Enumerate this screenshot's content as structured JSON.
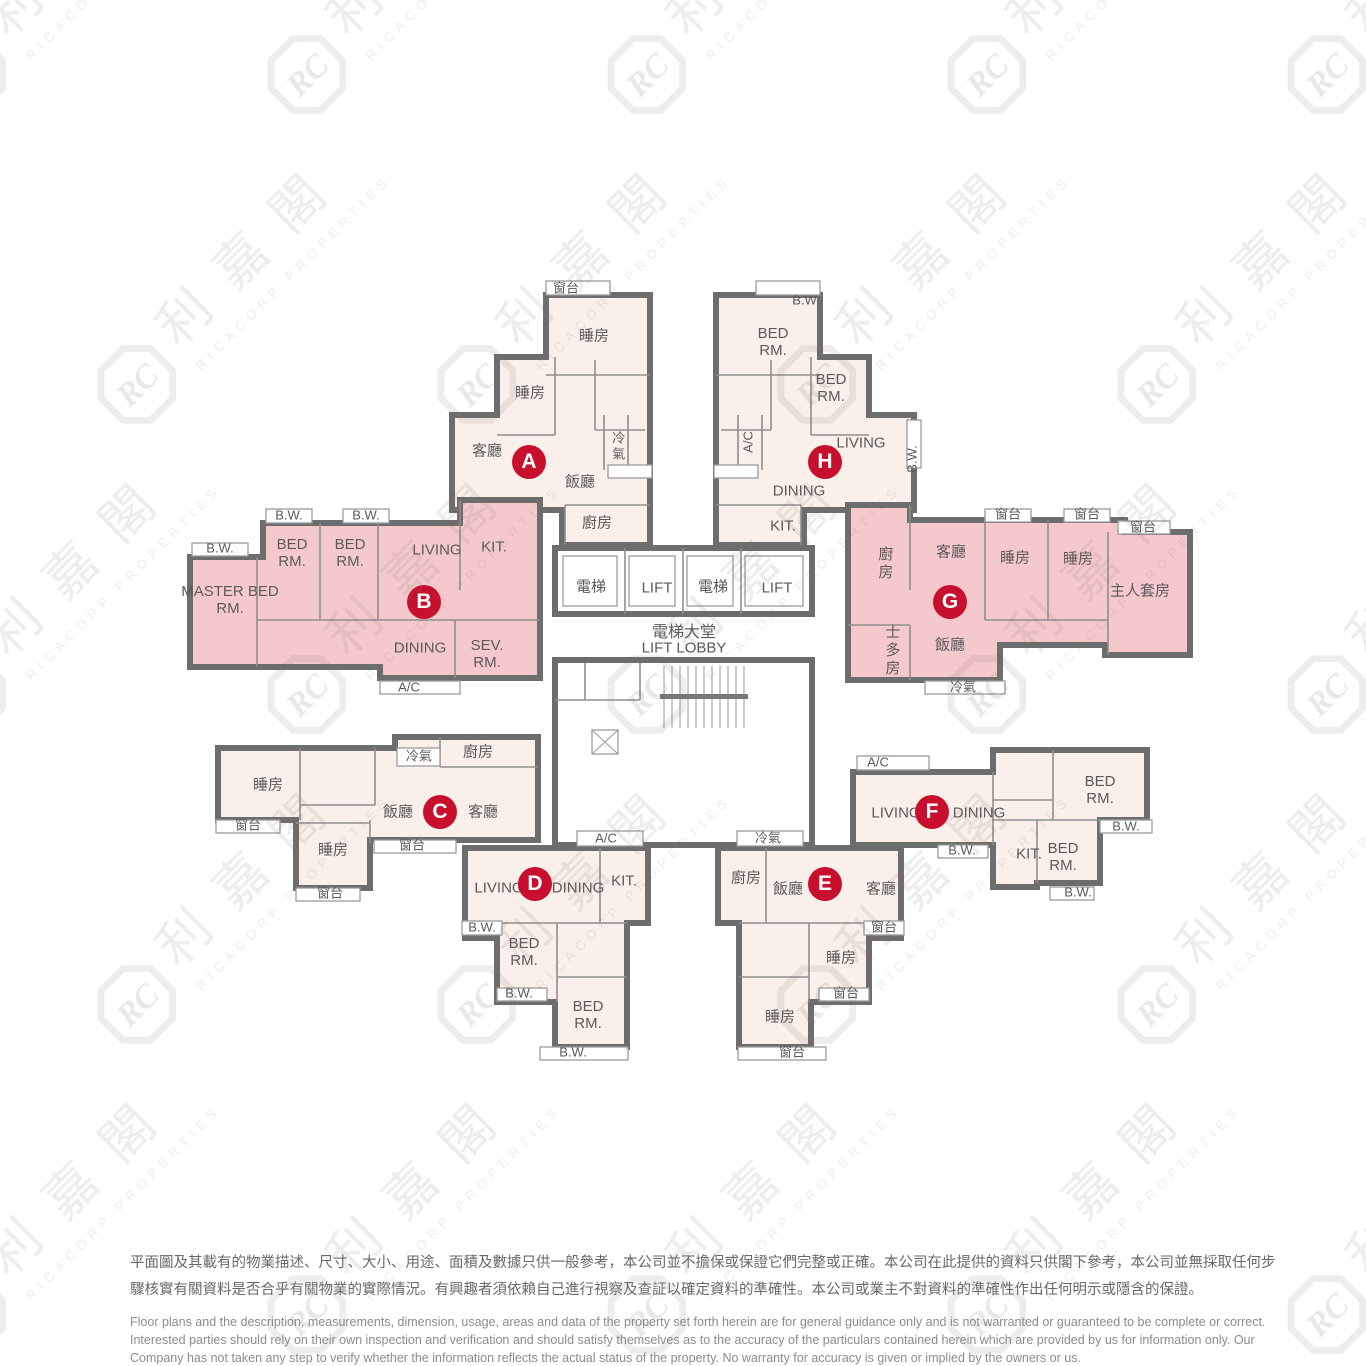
{
  "watermark": {
    "logo_text": "RC",
    "cjk": "利嘉閣",
    "en": "RICACORP PROPERTIES"
  },
  "core": {
    "lift1": "電梯",
    "lift2": "LIFT",
    "lift3": "電梯",
    "lift4": "LIFT",
    "lobby_cjk": "電梯大堂",
    "lobby_en": "LIFT LOBBY",
    "ac": "A/C",
    "cold": "冷氣"
  },
  "units": {
    "A": {
      "letter": "A",
      "bay": "窗台",
      "bed1": "睡房",
      "bed2": "睡房",
      "living": "客廳",
      "dining": "飯廳",
      "cold": "冷氣",
      "kitchen": "廚房"
    },
    "B": {
      "letter": "B",
      "bw1": "B.W.",
      "bw2": "B.W.",
      "bw3": "B.W.",
      "bed1": "BED RM.",
      "bed2": "BED RM.",
      "living": "LIVING",
      "kitchen": "KIT.",
      "master": "MASTER BED RM.",
      "dining": "DINING",
      "service": "SEV. RM.",
      "ac": "A/C"
    },
    "C": {
      "letter": "C",
      "bed1": "睡房",
      "bay1": "窗台",
      "bed2": "睡房",
      "bay2": "窗台",
      "cold": "冷氣",
      "kitchen": "廚房",
      "dining": "飯廳",
      "living": "客廳",
      "bay3": "窗台"
    },
    "D": {
      "letter": "D",
      "living": "LIVING",
      "dining": "DINING",
      "kitchen": "KIT.",
      "bw1": "B.W.",
      "bed1": "BED RM.",
      "bw2": "B.W.",
      "bed2": "BED RM.",
      "bw3": "B.W."
    },
    "E": {
      "letter": "E",
      "kitchen": "廚房",
      "dining": "飯廳",
      "living": "客廳",
      "bay1": "窗台",
      "bed1": "睡房",
      "bay2": "窗台",
      "bed2": "睡房",
      "bay3": "窗台"
    },
    "F": {
      "letter": "F",
      "ac": "A/C",
      "living": "LIVING",
      "dining": "DINING",
      "bed1": "BED RM.",
      "bw1": "B.W.",
      "bw2": "B.W.",
      "kitchen": "KIT.",
      "bed2": "BED RM.",
      "bw3": "B.W."
    },
    "G": {
      "letter": "G",
      "kitchen": "廚房",
      "living": "客廳",
      "bay1": "窗台",
      "bay2": "窗台",
      "bay3": "窗台",
      "bed1": "睡房",
      "bed2": "睡房",
      "master": "主人套房",
      "store": "士多房",
      "dining": "飯廳",
      "cold": "冷氣"
    },
    "H": {
      "letter": "H",
      "bw1": "B.W.",
      "bed1": "BED RM.",
      "bed2": "BED RM.",
      "living": "LIVING",
      "bw2": "B.W.",
      "ac": "A/C",
      "dining": "DINING",
      "kitchen": "KIT."
    }
  },
  "disclaimer": {
    "zh1": "平面圖及其載有的物業描述、尺寸、大小、用途、面積及數據只供一般參考，本公司並不擔保或保證它們完整或正確。本公司在此提供的資料只供閣下參考，本公司並無採取任何步",
    "zh2": "驟核實有關資料是否合乎有關物業的實際情況。有興趣者須依賴自己進行視察及查証以確定資料的準確性。本公司或業主不對資料的準確性作出任何明示或隱含的保證。",
    "en1": "Floor plans and the description, measurements, dimension, usage, areas and data of the property set forth herein are for general guidance only and is not warranted or guaranteed to be complete or correct.",
    "en2": "Interested parties should rely on their own inspection and verification and should satisfy themselves as to the accuracy of the particulars contained herein which are provided by us for information only.  Our",
    "en3": "Company has not taken any step to verify whether the information reflects the actual status of the property.  No warranty for accuracy is given or implied by the owners or us."
  },
  "colors": {
    "unit_light": "#FAF0E9",
    "unit_highlight": "#F5C9CC",
    "wall": "#6E6D6D",
    "accent": "#C8102E"
  }
}
